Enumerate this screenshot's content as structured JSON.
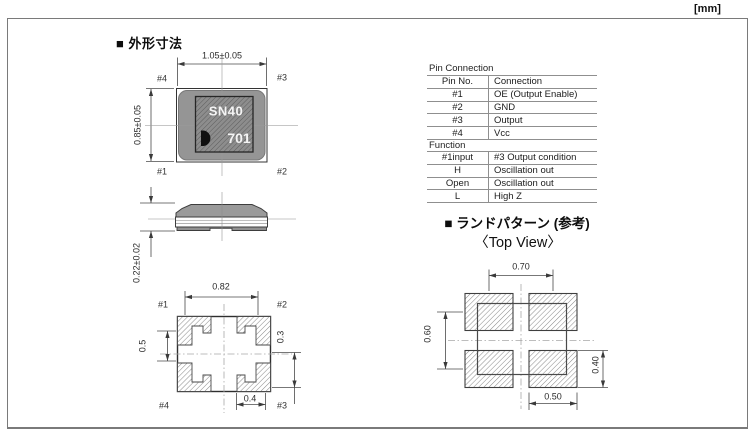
{
  "unit_label": "[mm]",
  "outline": {
    "title": "■ 外形寸法",
    "top_view": {
      "dim_width": "1.05±0.05",
      "dim_height": "0.85±0.05",
      "pins": {
        "top_left": "#4",
        "top_right": "#3",
        "bottom_left": "#1",
        "bottom_right": "#2"
      },
      "marking": {
        "line1": "SN40",
        "line2": "701",
        "logo_icon": "kds-crescent-logo"
      }
    },
    "side_view": {
      "dim_thickness": "0.22±0.02"
    },
    "bottom_view": {
      "dim_inner_width": "0.82",
      "dim_left": "0.5",
      "dim_right": "0.3",
      "dim_pad_width": "0.4",
      "pins": {
        "top_left": "#1",
        "top_right": "#2",
        "bottom_left": "#4",
        "bottom_right": "#3"
      }
    }
  },
  "pin_connection": {
    "label": "Pin Connection",
    "headers": [
      "Pin No.",
      "Connection"
    ],
    "rows": [
      [
        "#1",
        "OE (Output Enable)"
      ],
      [
        "#2",
        "GND"
      ],
      [
        "#3",
        "Output"
      ],
      [
        "#4",
        "Vcc"
      ]
    ]
  },
  "function_table": {
    "label": "Function",
    "headers": [
      "#1input",
      "#3 Output condition"
    ],
    "rows": [
      [
        "H",
        "Oscillation out"
      ],
      [
        "Open",
        "Oscillation out"
      ],
      [
        "L",
        "High Z"
      ]
    ]
  },
  "land_pattern": {
    "title": "■ ランドパターン (参考)",
    "subtitle": "〈Top View〉",
    "dims": {
      "pitch_x": "0.70",
      "pitch_y": "0.60",
      "pad_height": "0.40",
      "pad_width": "0.50"
    }
  },
  "colors": {
    "package_body": "#959595",
    "marking_base": "#8d8d8d",
    "line": "#4a4a4a"
  }
}
